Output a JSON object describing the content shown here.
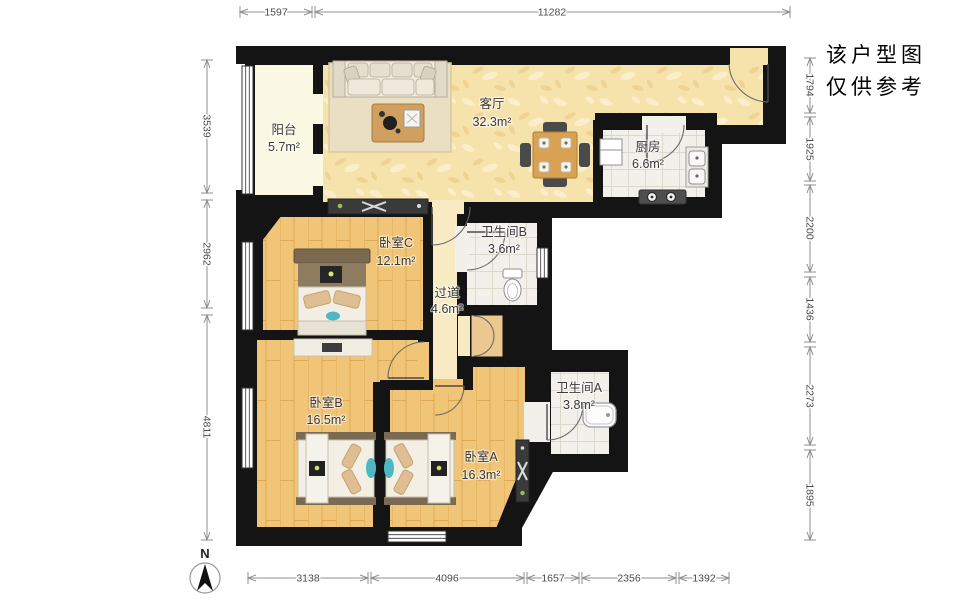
{
  "note": {
    "line1": "该户型图",
    "line2": "仅供参考"
  },
  "compass": {
    "label": "N"
  },
  "rooms": {
    "balcony": {
      "name": "阳台",
      "area": "5.7m²"
    },
    "living": {
      "name": "客厅",
      "area": "32.3m²"
    },
    "kitchen": {
      "name": "厨房",
      "area": "6.6m²"
    },
    "bedroomC": {
      "name": "卧室C",
      "area": "12.1m²"
    },
    "bathroomB": {
      "name": "卫生间B",
      "area": "3.6m²"
    },
    "hallway": {
      "name": "过道",
      "area": "4.6m²"
    },
    "bedroomB": {
      "name": "卧室B",
      "area": "16.5m²"
    },
    "bedroomA": {
      "name": "卧室A",
      "area": "16.3m²"
    },
    "bathroomA": {
      "name": "卫生间A",
      "area": "3.8m²"
    }
  },
  "dimensions": {
    "top": [
      "1597",
      "11282"
    ],
    "bottom": [
      "3138",
      "4096",
      "1657",
      "2356",
      "1392"
    ],
    "left": [
      "3539",
      "2962",
      "4811"
    ],
    "right": [
      "1794",
      "1925",
      "2200",
      "1436",
      "2273",
      "1895"
    ]
  },
  "colors": {
    "wall": "#141414",
    "living_floor": "#f6e2ab",
    "wood_floor": "#f0c577",
    "tile_floor": "#f2f0ea",
    "balcony_floor": "#fbf8e3",
    "accent_teal": "#4fb7c3"
  }
}
